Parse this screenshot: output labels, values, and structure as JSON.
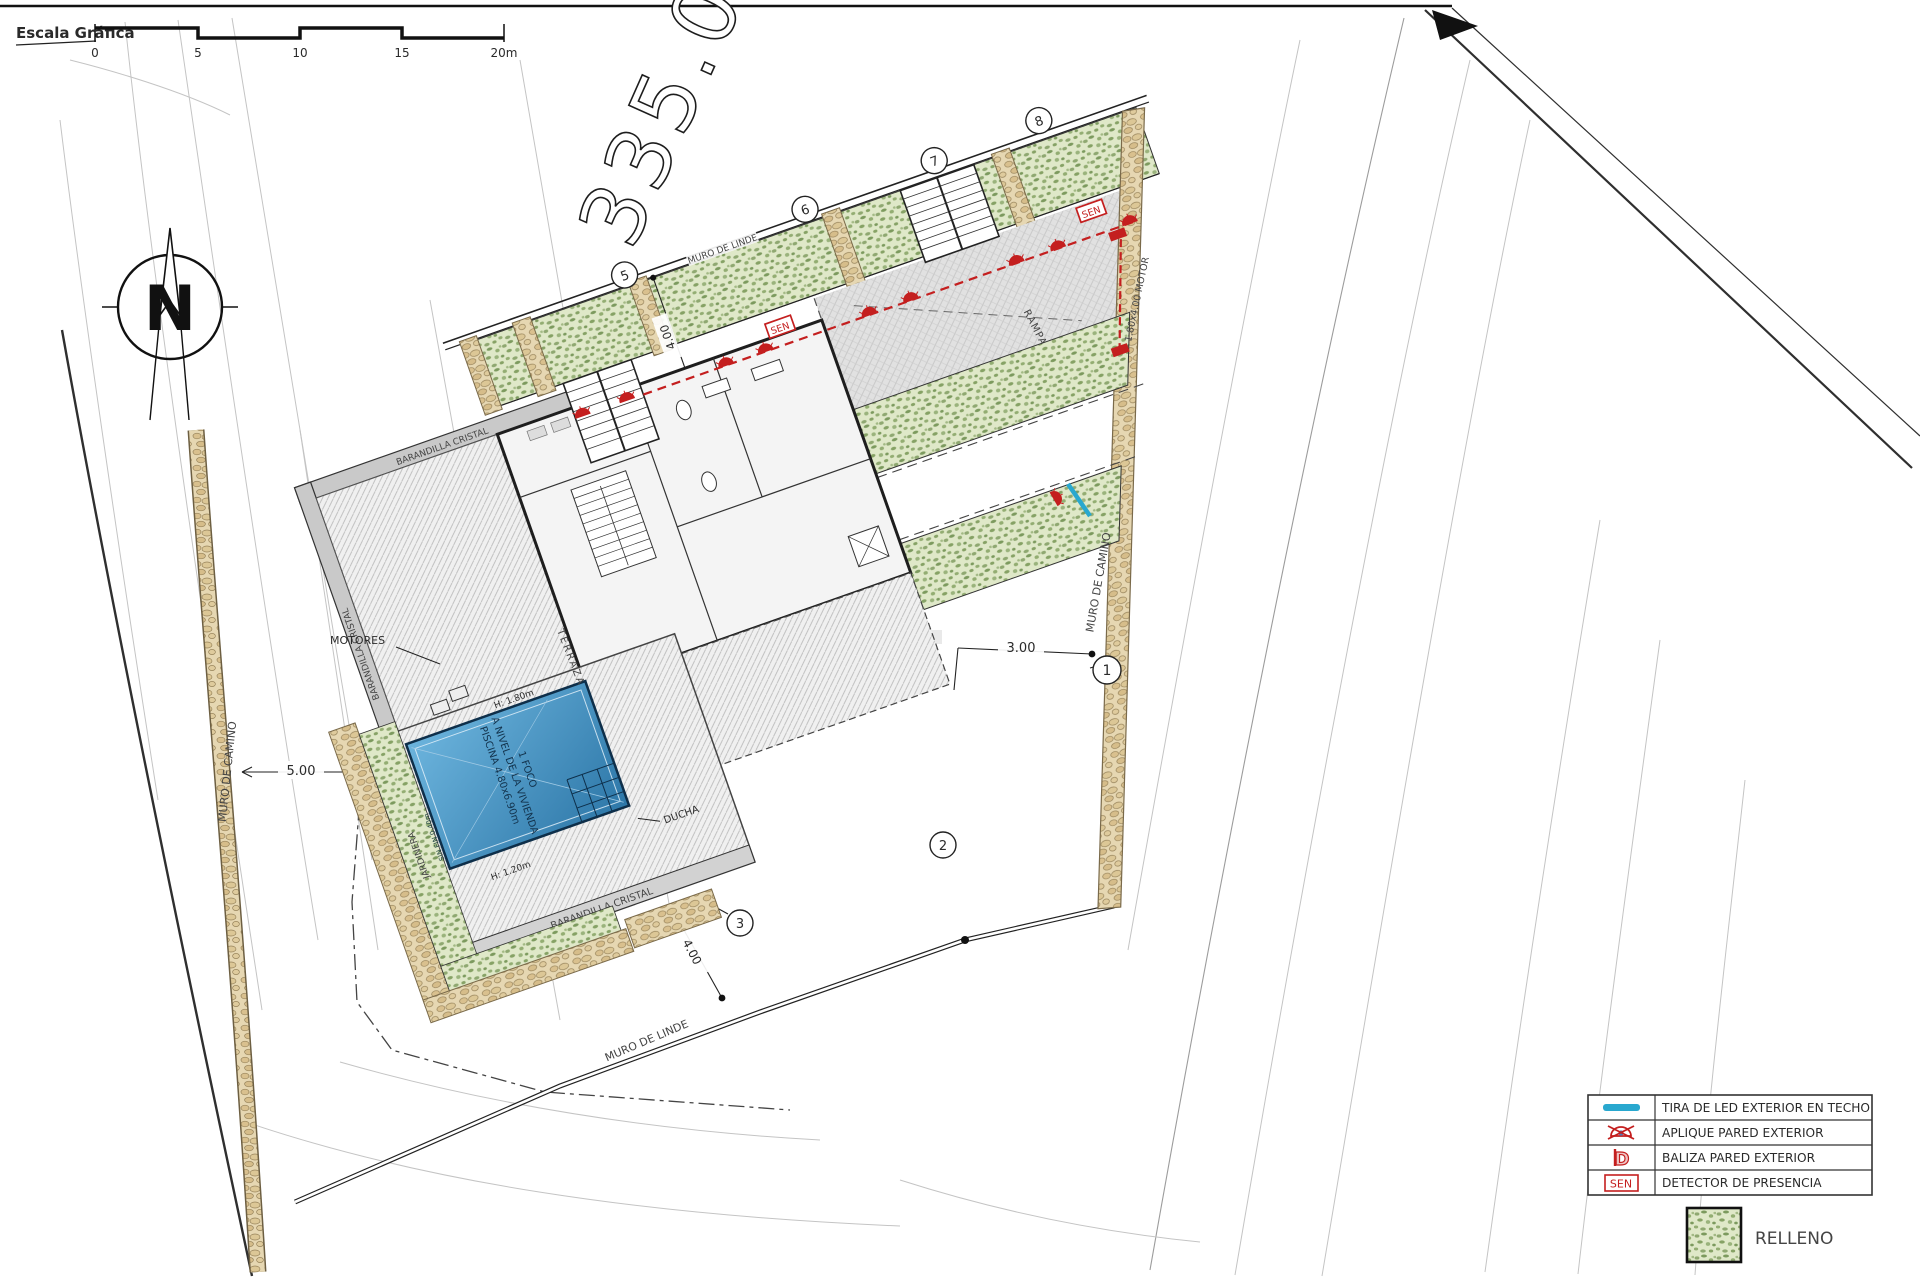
{
  "scale_bar": {
    "title": "Escala Gráfica",
    "ticks": [
      "0",
      "5",
      "10",
      "15",
      "20m"
    ]
  },
  "compass": {
    "north_label": "N"
  },
  "plot": {
    "big_number": "335.0",
    "muro_linde_top": "MURO DE LINDE",
    "muro_linde_bottom": "MURO DE LINDE",
    "muro_camino_left": "MURO DE CAMINO",
    "muro_camino_right": "MURO DE CAMINO",
    "markers": {
      "m1": "1",
      "m2": "2",
      "m3": "3",
      "m5": "5",
      "m6": "6",
      "m7": "7",
      "m8": "8"
    }
  },
  "site": {
    "rampa": "RAMPA",
    "jardinera_top": "JARDINERA",
    "jardinera_pool": "JARDINERA",
    "terraza": "TERRAZA",
    "ducha": "DUCHA",
    "motores": "MOTORES",
    "barandilla_top": "BARANDILLA CRISTAL",
    "barandilla_left": "BARANDILLA CRISTAL",
    "barandilla_pool": "BARANDILLA CRISTAL",
    "gate_motor": "1.80x4.00 MOTOR",
    "sen_label": "SEN",
    "pool": {
      "line1": "PISCINA 4.80x6.90m",
      "line2": "A NIVEL DE LA VIVIENDA",
      "line3": "1 FOCO",
      "depth_max": "H: 1.80m",
      "depth_min": "H: 1.20m",
      "edge": "SIN FIN 0.40m"
    }
  },
  "dimensions": {
    "left_setback": "5.00",
    "top_offset": "4.00",
    "bottom_offset": "4.00",
    "right_strip": "3.00"
  },
  "legend": {
    "rows": [
      {
        "icon": "led-strip-icon",
        "label": "TIRA DE LED EXTERIOR EN TECHO"
      },
      {
        "icon": "wall-sconce-crossed-icon",
        "label": "APLIQUE PARED EXTERIOR"
      },
      {
        "icon": "beacon-icon",
        "label": "BALIZA PARED EXTERIOR"
      },
      {
        "icon": "sen-box-icon",
        "label": "DETECTOR DE PRESENCIA"
      }
    ],
    "sen_icon_text": "SEN",
    "beacon_icon_text": "D",
    "fill_swatch_label": "RELLENO"
  },
  "colors": {
    "led_cyan": "#29a8cf",
    "device_red": "#c41f1f",
    "pool_blue": "#3f8fc4",
    "relleno_green": "#8fa871",
    "stone_tan": "#e6d7b2"
  }
}
